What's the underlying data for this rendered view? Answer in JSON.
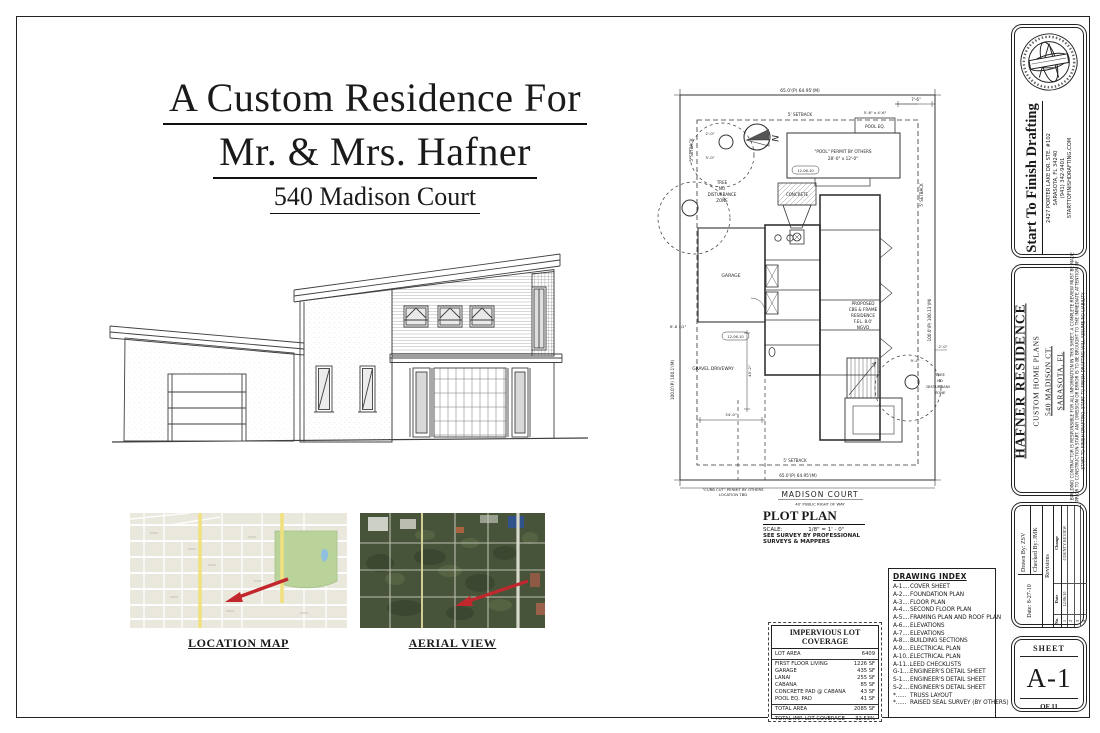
{
  "cover": {
    "title_line1": "A Custom Residence For",
    "title_line2": "Mr. & Mrs. Hafner",
    "address_line": "540 Madison Court"
  },
  "maps": {
    "location_label": "LOCATION MAP",
    "aerial_label": "AERIAL VIEW"
  },
  "plot_plan": {
    "heading": "PLOT PLAN",
    "scale_label": "SCALE:",
    "scale_value": "1/8\" = 1' - 0\"",
    "survey_note_line1": "SEE SURVEY BY PROFESSIONAL",
    "survey_note_line2": "SURVEYS & MAPPERS",
    "street_name": "MADISON COURT",
    "street_row": "40' PUBLIC RIGHT OF WAY",
    "dim_top": "65.0'(P) 64.95'(M)",
    "dim_bottom": "65.0'(P) 64.95'(M)",
    "dim_left": "100.0'(P) 100.1'(M)",
    "dim_right": "100.0'(P) 100.13'(M)",
    "setback": "5' SETBACK",
    "pool_label_line1": "\"POOL\" PERMIT BY OTHERS",
    "pool_label_line2": "28'-0\" x 12'-0\"",
    "pool_eq_label": "POOL EQ.",
    "pool_eq_size": "5'-6\" x 4'-6\"",
    "concrete_label": "CONCRETE",
    "garage_label": "GARAGE",
    "residence_label": [
      "PROPOSED",
      "CBS & FRAME",
      "RESIDENCE",
      "F.EL. 8.0'",
      "NGVD"
    ],
    "tree_zone_label": [
      "TREE",
      "NO",
      "DISTURBANCE",
      "ZONE"
    ],
    "gravel_label": "GRAVEL DRIVEWAY",
    "curb_note_line1": "\"CURB CUT\" PERMIT BY OTHERS",
    "curb_note_line2": "LOCATION TBD",
    "north_label": "N",
    "rev_tag": "12-06-10",
    "dim_7_6": "7'-6\"",
    "dim_5_0": "5'-0\"",
    "dim_2_0": "2'-0\"",
    "dim_9_4": "9'-4\"",
    "dim_34_0": "34'-0\"",
    "dim_45_2": "45'-2\"",
    "dim_6_8": "6'-8 1/2\""
  },
  "drawing_index": {
    "title": "DRAWING INDEX",
    "items": [
      {
        "code": "A-1....",
        "name": "COVER SHEET"
      },
      {
        "code": "A-2....",
        "name": "FOUNDATION PLAN"
      },
      {
        "code": "A-3....",
        "name": "FLOOR PLAN"
      },
      {
        "code": "A-4....",
        "name": "SECOND FLOOR PLAN"
      },
      {
        "code": "A-5....",
        "name": "FRAMING PLAN AND ROOF PLAN"
      },
      {
        "code": "A-6....",
        "name": "ELEVATIONS"
      },
      {
        "code": "A-7....",
        "name": "ELEVATIONS"
      },
      {
        "code": "A-8....",
        "name": "BUILDING SECTIONS"
      },
      {
        "code": "A-9....",
        "name": "ELECTRICAL PLAN"
      },
      {
        "code": "A-10...",
        "name": "ELECTRICAL PLAN"
      },
      {
        "code": "A-11...",
        "name": "LEED CHECKLISTS"
      },
      {
        "code": "G-1....",
        "name": "ENGINEER'S DETAIL SHEET"
      },
      {
        "code": "S-1....",
        "name": "ENGINEER'S DETAIL SHEET"
      },
      {
        "code": "S-2....",
        "name": "ENGINEER'S DETAIL SHEET"
      },
      {
        "code": "*......",
        "name": "TRUSS LAYOUT"
      },
      {
        "code": "*......",
        "name": "RAISED SEAL SURVEY (BY OTHERS)"
      }
    ]
  },
  "lot_coverage": {
    "title": "IMPERVIOUS LOT COVERAGE",
    "lot_area_label": "LOT AREA",
    "lot_area_value": "6409",
    "rows": [
      {
        "label": "FIRST FLOOR LIVING",
        "value": "1226 SF"
      },
      {
        "label": "GARAGE",
        "value": "435 SF"
      },
      {
        "label": "LANAI",
        "value": "255 SF"
      },
      {
        "label": "CABANA",
        "value": "85 SF"
      },
      {
        "label": "CONCRETE PAD @ CABANA",
        "value": "43 SF"
      },
      {
        "label": "POOL EQ. PAD",
        "value": "41 SF"
      }
    ],
    "total_label": "TOTAL AREA",
    "total_value": "2085 SF",
    "coverage_label": "TOTAL IMP. LOT COVERAGE",
    "coverage_value": "32.53%"
  },
  "title_block": {
    "firm_name": "Start To Finish Drafting",
    "firm_address_line1": "2427 PORTER LAKE DR. STE. #102",
    "firm_address_line2": "SARASOTA, FL 34240",
    "firm_address_line3": "(941) 342-9401",
    "firm_address_line4": "STARTTOFINISHDRAFTING.COM",
    "project_name": "HAFNER RESIDENCE",
    "project_type": "CUSTOM HOME PLANS",
    "project_street": "540 MADISON CT.",
    "project_city": "SARASOTA, FL",
    "disclaimer_line1": "THE BUILDING CONTRACTOR IS RESPONSIBLE FOR ALL INFORMATION IN THIS SHEET. A COMPLETE REVIEW MUST BE MADE",
    "disclaimer_line2": "PRIOR TO CONSTRUCTION START. ANY OMISSION OR ERROR IS TO BE BROUGHT TO THE IMMEDIATE ATTENTION OF",
    "disclaimer_line3": "START TO FINISH DRAFTING. START TO FINISH DRAFTING WILL ASSUME NO LIABILITY",
    "date_label": "Date:",
    "date_value": "8-27-10",
    "drawn_label": "Drawn By:",
    "drawn_value": "ZSV",
    "checked_label": "Checked By:",
    "checked_value": "JMK",
    "revisions_title": "Revisions",
    "rev_col_no": "No.",
    "rev_col_date": "Date",
    "rev_col_change": "Change",
    "revisions": [
      {
        "no": "1",
        "date": "12/06/10",
        "change": "COUNTY REVIEW"
      },
      {
        "no": "2",
        "date": "",
        "change": ""
      },
      {
        "no": "3",
        "date": "",
        "change": ""
      },
      {
        "no": "4",
        "date": "",
        "change": ""
      }
    ],
    "sheet_label": "SHEET",
    "sheet_number": "A-1",
    "sheet_of": "OF 11"
  }
}
